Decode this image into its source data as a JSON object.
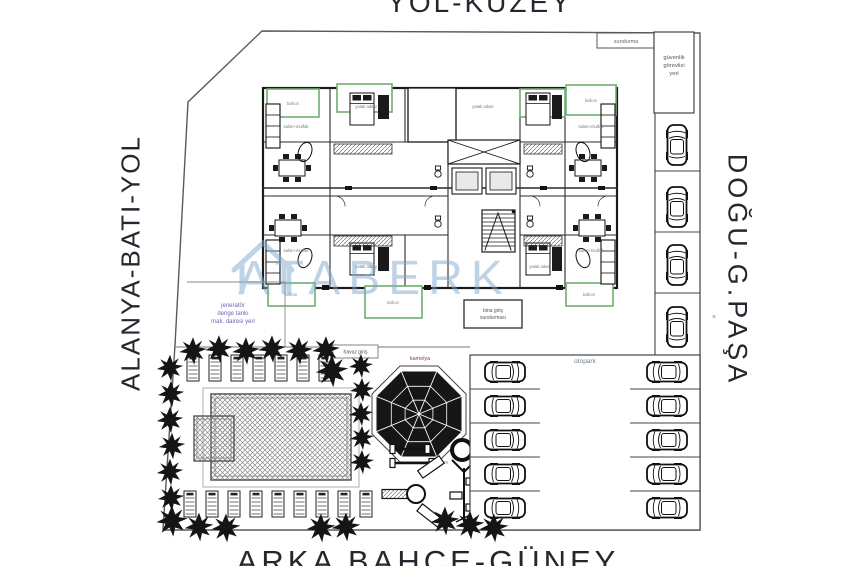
{
  "roads": {
    "north": "YOL-KUZEY",
    "south": "ARKA BAHÇE-GÜNEY",
    "west": "ALANYA-BATI-YOL",
    "east": "DOĞU-G.PAŞA"
  },
  "site": {
    "canopy_label": "sundurma",
    "security_lines": [
      "güvenlik",
      "görevlisi",
      "yeri"
    ],
    "generator_lines": [
      "jeneratör",
      "denge tankı",
      "mak. dairesi yeri"
    ],
    "entrance_lines": [
      "bina giriş",
      "sundurması"
    ],
    "pool_entry_label": "havuz giriş",
    "gazebo_label": "kamelya",
    "playground_label": "oyun alanı",
    "parking_label": "otopark",
    "marker": "×"
  },
  "plan": {
    "balcony_label": "balkon",
    "living_label": "salon+mutfak",
    "bedroom_label": "yatak odası"
  },
  "watermark": {
    "text": "ATABERK"
  },
  "colors": {
    "balcony_green": "#6fae6f",
    "watermark_blue": "#7fa8cc",
    "ink": "#1d1d1d",
    "boundary": "#5a5a5a"
  }
}
